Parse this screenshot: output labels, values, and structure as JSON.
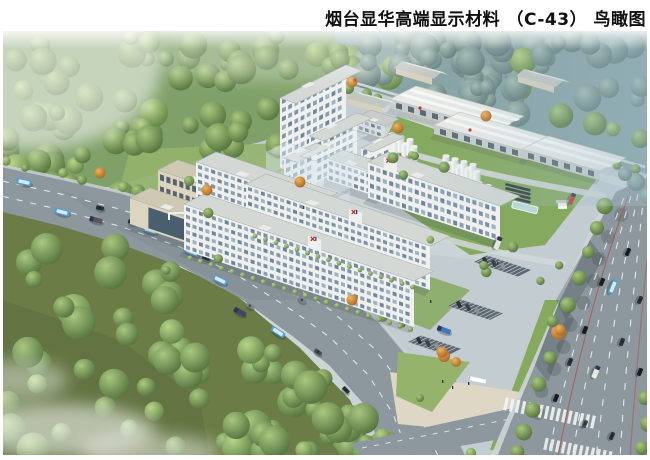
{
  "page": {
    "title": "烟台显华高端显示材料 （C-43） 鸟瞰图"
  },
  "rendering": {
    "subject": "industrial park aerial bird's-eye rendering",
    "logo_mark": "XH",
    "colors": {
      "page_bg": "#ffffff",
      "title_text": "#101010",
      "sky_top": "#d9e4e0",
      "sky_bottom": "#c6d1d1",
      "forest_green": "#7fa069",
      "forest_blue_green": "#87a3a4",
      "ground_olive": "#6b7c46",
      "lawn": "#85a95e",
      "lawn_bright": "#95b36a",
      "pavement": "#c3ccd1",
      "walk_beige": "#ded7c6",
      "road": "#8d979e",
      "road_dark": "#737e86",
      "lane_white": "#f2f4f4",
      "median_red": "#a85a52",
      "building_white": "#f0f1ef",
      "building_end": "#d8dee0",
      "roof_gray": "#d3d8d4",
      "parapet": "#a9b2b2",
      "beige_wall": "#dcd5bf",
      "beige_end": "#c5bda6",
      "beige_roof": "#cfc8b2",
      "glass_dark": "#3c5568",
      "warehouse_roof": "#e8eae6",
      "warehouse_wall": "#c9cdcb",
      "parking": "#5c6873",
      "logo_red": "#cc2222",
      "logo_blue": "#1d4fa0",
      "bus_blue": "#4da3d8",
      "car_dark": "#2b3138"
    }
  }
}
